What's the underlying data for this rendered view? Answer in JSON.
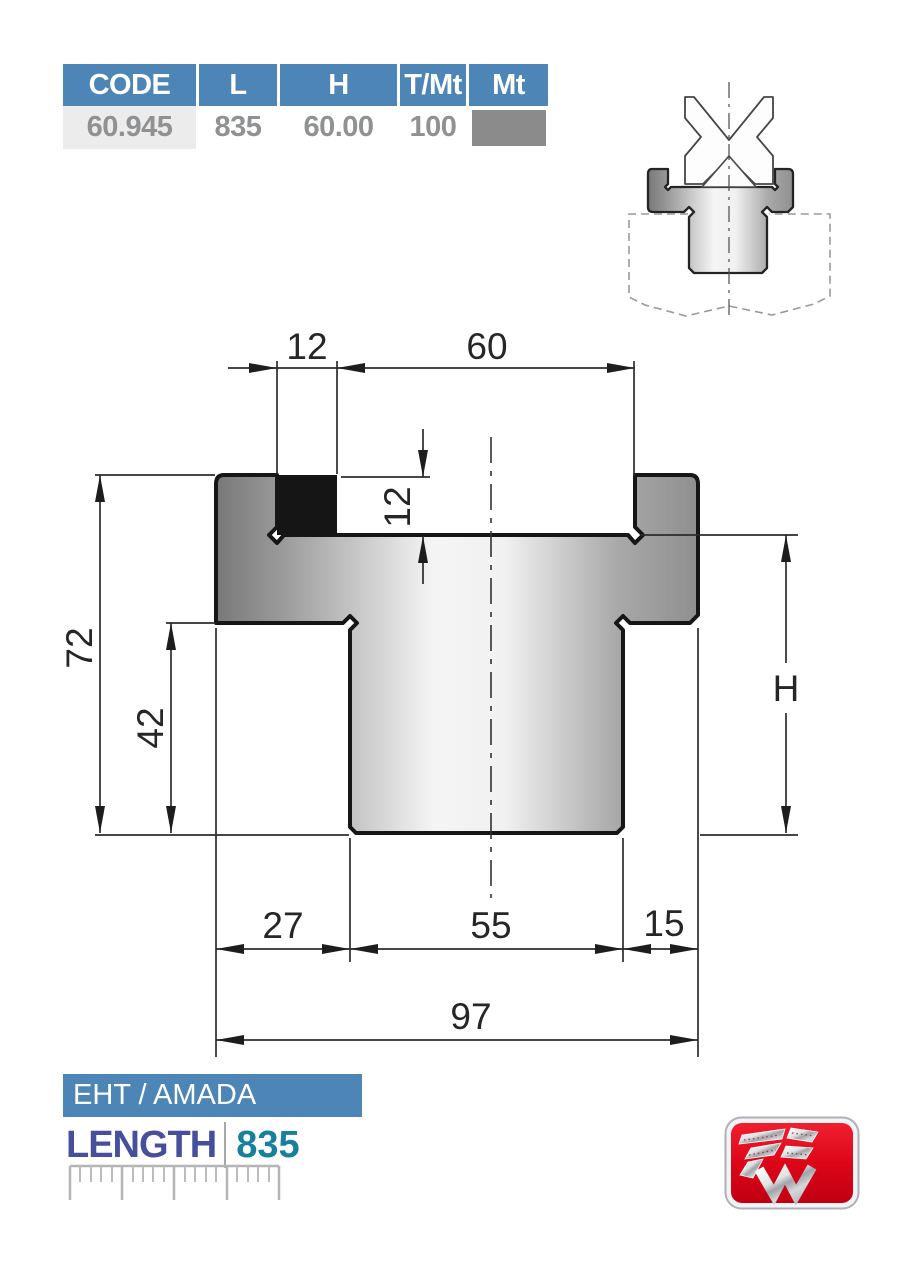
{
  "table": {
    "headers": [
      "CODE",
      "L",
      "H",
      "T/Mt",
      "Mt"
    ],
    "row": {
      "code": "60.945",
      "l": "835",
      "h": "60.00",
      "t_mt": "100"
    }
  },
  "drawing": {
    "dims": {
      "groove_offset": "12",
      "groove_width": "60",
      "groove_depth": "12",
      "total_height": "72",
      "stem_height": "42",
      "body_height_label": "H",
      "bottom_left": "27",
      "stem_width": "55",
      "bottom_right": "15",
      "total_width": "97"
    }
  },
  "footer": {
    "brand": "EHT / AMADA",
    "length_label": "LENGTH",
    "length_value": "835"
  },
  "icons": {
    "logo": "tsw-logo"
  },
  "colors": {
    "accent_blue": "#4d86b6",
    "code_cell_bg": "#ececec",
    "value_text": "#8f9193",
    "swatch_gray": "#8b8b8b",
    "length_label_color": "#454f9c",
    "length_value_color": "#17809f",
    "logo_red": "#dd0618"
  }
}
